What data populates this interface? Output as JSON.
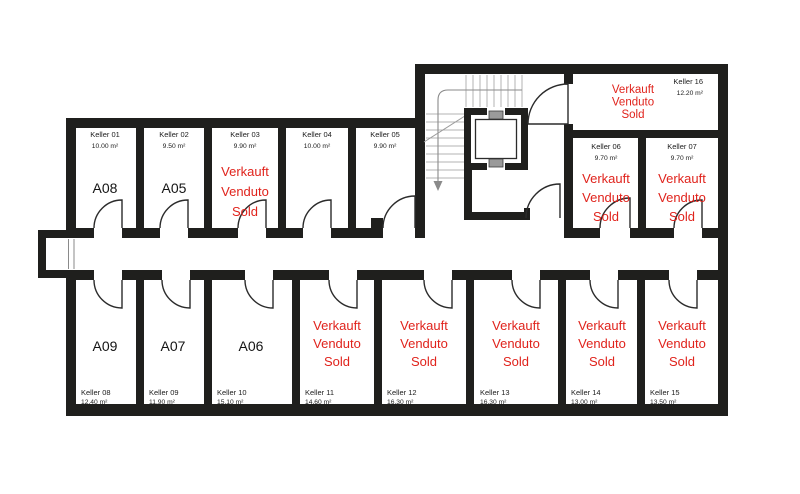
{
  "palette": {
    "wall": "#1f1f1d",
    "sold_red": "#e0231c",
    "label_text": "#1c1c1c"
  },
  "sold_label_lines": [
    "Verkauft",
    "Venduto",
    "Sold"
  ],
  "rooms": [
    {
      "id": "keller-01",
      "name": "Keller 01",
      "area": "10.00 m²",
      "anchor": "middle",
      "name_x": 105,
      "name_y": 137,
      "area_y": 148,
      "unit": "A08",
      "unit_x": 105,
      "unit_y": 193
    },
    {
      "id": "keller-02",
      "name": "Keller 02",
      "area": "9.50 m²",
      "anchor": "middle",
      "name_x": 174,
      "name_y": 137,
      "area_y": 148,
      "unit": "A05",
      "unit_x": 174,
      "unit_y": 193
    },
    {
      "id": "keller-03",
      "name": "Keller 03",
      "area": "9.90 m²",
      "anchor": "middle",
      "name_x": 245,
      "name_y": 137,
      "area_y": 148,
      "sold": true,
      "status_x": 245,
      "status_y": 176,
      "status_lh": 20
    },
    {
      "id": "keller-04",
      "name": "Keller 04",
      "area": "10.00 m²",
      "anchor": "middle",
      "name_x": 317,
      "name_y": 137,
      "area_y": 148
    },
    {
      "id": "keller-05",
      "name": "Keller 05",
      "area": "9.90 m²",
      "anchor": "middle",
      "name_x": 385,
      "name_y": 137,
      "area_y": 148
    },
    {
      "id": "keller-06",
      "name": "Keller 06",
      "area": "9.70 m²",
      "anchor": "middle",
      "name_x": 606,
      "name_y": 149,
      "area_y": 160,
      "sold": true,
      "status_x": 606,
      "status_y": 183,
      "status_lh": 19
    },
    {
      "id": "keller-07",
      "name": "Keller 07",
      "area": "9.70 m²",
      "anchor": "middle",
      "name_x": 682,
      "name_y": 149,
      "area_y": 160,
      "sold": true,
      "status_x": 682,
      "status_y": 183,
      "status_lh": 19
    },
    {
      "id": "keller-08",
      "name": "Keller 08",
      "area": "12.40 m²",
      "anchor": "start",
      "name_x": 81,
      "name_y": 395,
      "area_y": 404,
      "unit": "A09",
      "unit_x": 105,
      "unit_y": 351
    },
    {
      "id": "keller-09",
      "name": "Keller 09",
      "area": "11.90 m²",
      "anchor": "start",
      "name_x": 149,
      "name_y": 395,
      "area_y": 404,
      "unit": "A07",
      "unit_x": 173,
      "unit_y": 351
    },
    {
      "id": "keller-10",
      "name": "Keller 10",
      "area": "15.10 m²",
      "anchor": "start",
      "name_x": 217,
      "name_y": 395,
      "area_y": 404,
      "unit": "A06",
      "unit_x": 251,
      "unit_y": 351
    },
    {
      "id": "keller-11",
      "name": "Keller 11",
      "area": "14.60 m²",
      "anchor": "start",
      "name_x": 305,
      "name_y": 395,
      "area_y": 404,
      "sold": true,
      "status_x": 337,
      "status_y": 330,
      "status_lh": 18
    },
    {
      "id": "keller-12",
      "name": "Keller 12",
      "area": "16.30 m²",
      "anchor": "start",
      "name_x": 387,
      "name_y": 395,
      "area_y": 404,
      "sold": true,
      "status_x": 424,
      "status_y": 330,
      "status_lh": 18
    },
    {
      "id": "keller-13",
      "name": "Keller 13",
      "area": "16.30 m²",
      "anchor": "start",
      "name_x": 480,
      "name_y": 395,
      "area_y": 404,
      "sold": true,
      "status_x": 516,
      "status_y": 330,
      "status_lh": 18
    },
    {
      "id": "keller-14",
      "name": "Keller 14",
      "area": "13.00 m²",
      "anchor": "start",
      "name_x": 571,
      "name_y": 395,
      "area_y": 404,
      "sold": true,
      "status_x": 602,
      "status_y": 330,
      "status_lh": 18
    },
    {
      "id": "keller-15",
      "name": "Keller 15",
      "area": "13.50 m²",
      "anchor": "start",
      "name_x": 650,
      "name_y": 395,
      "area_y": 404,
      "sold": true,
      "status_x": 682,
      "status_y": 330,
      "status_lh": 18
    },
    {
      "id": "keller-16",
      "name": "Keller 16",
      "area": "12.20 m²",
      "anchor": "end",
      "name_x": 703,
      "name_y": 84,
      "area_y": 95,
      "sold": true,
      "status_x": 633,
      "status_y": 93,
      "status_lh": 12.5,
      "status_small": true
    }
  ]
}
